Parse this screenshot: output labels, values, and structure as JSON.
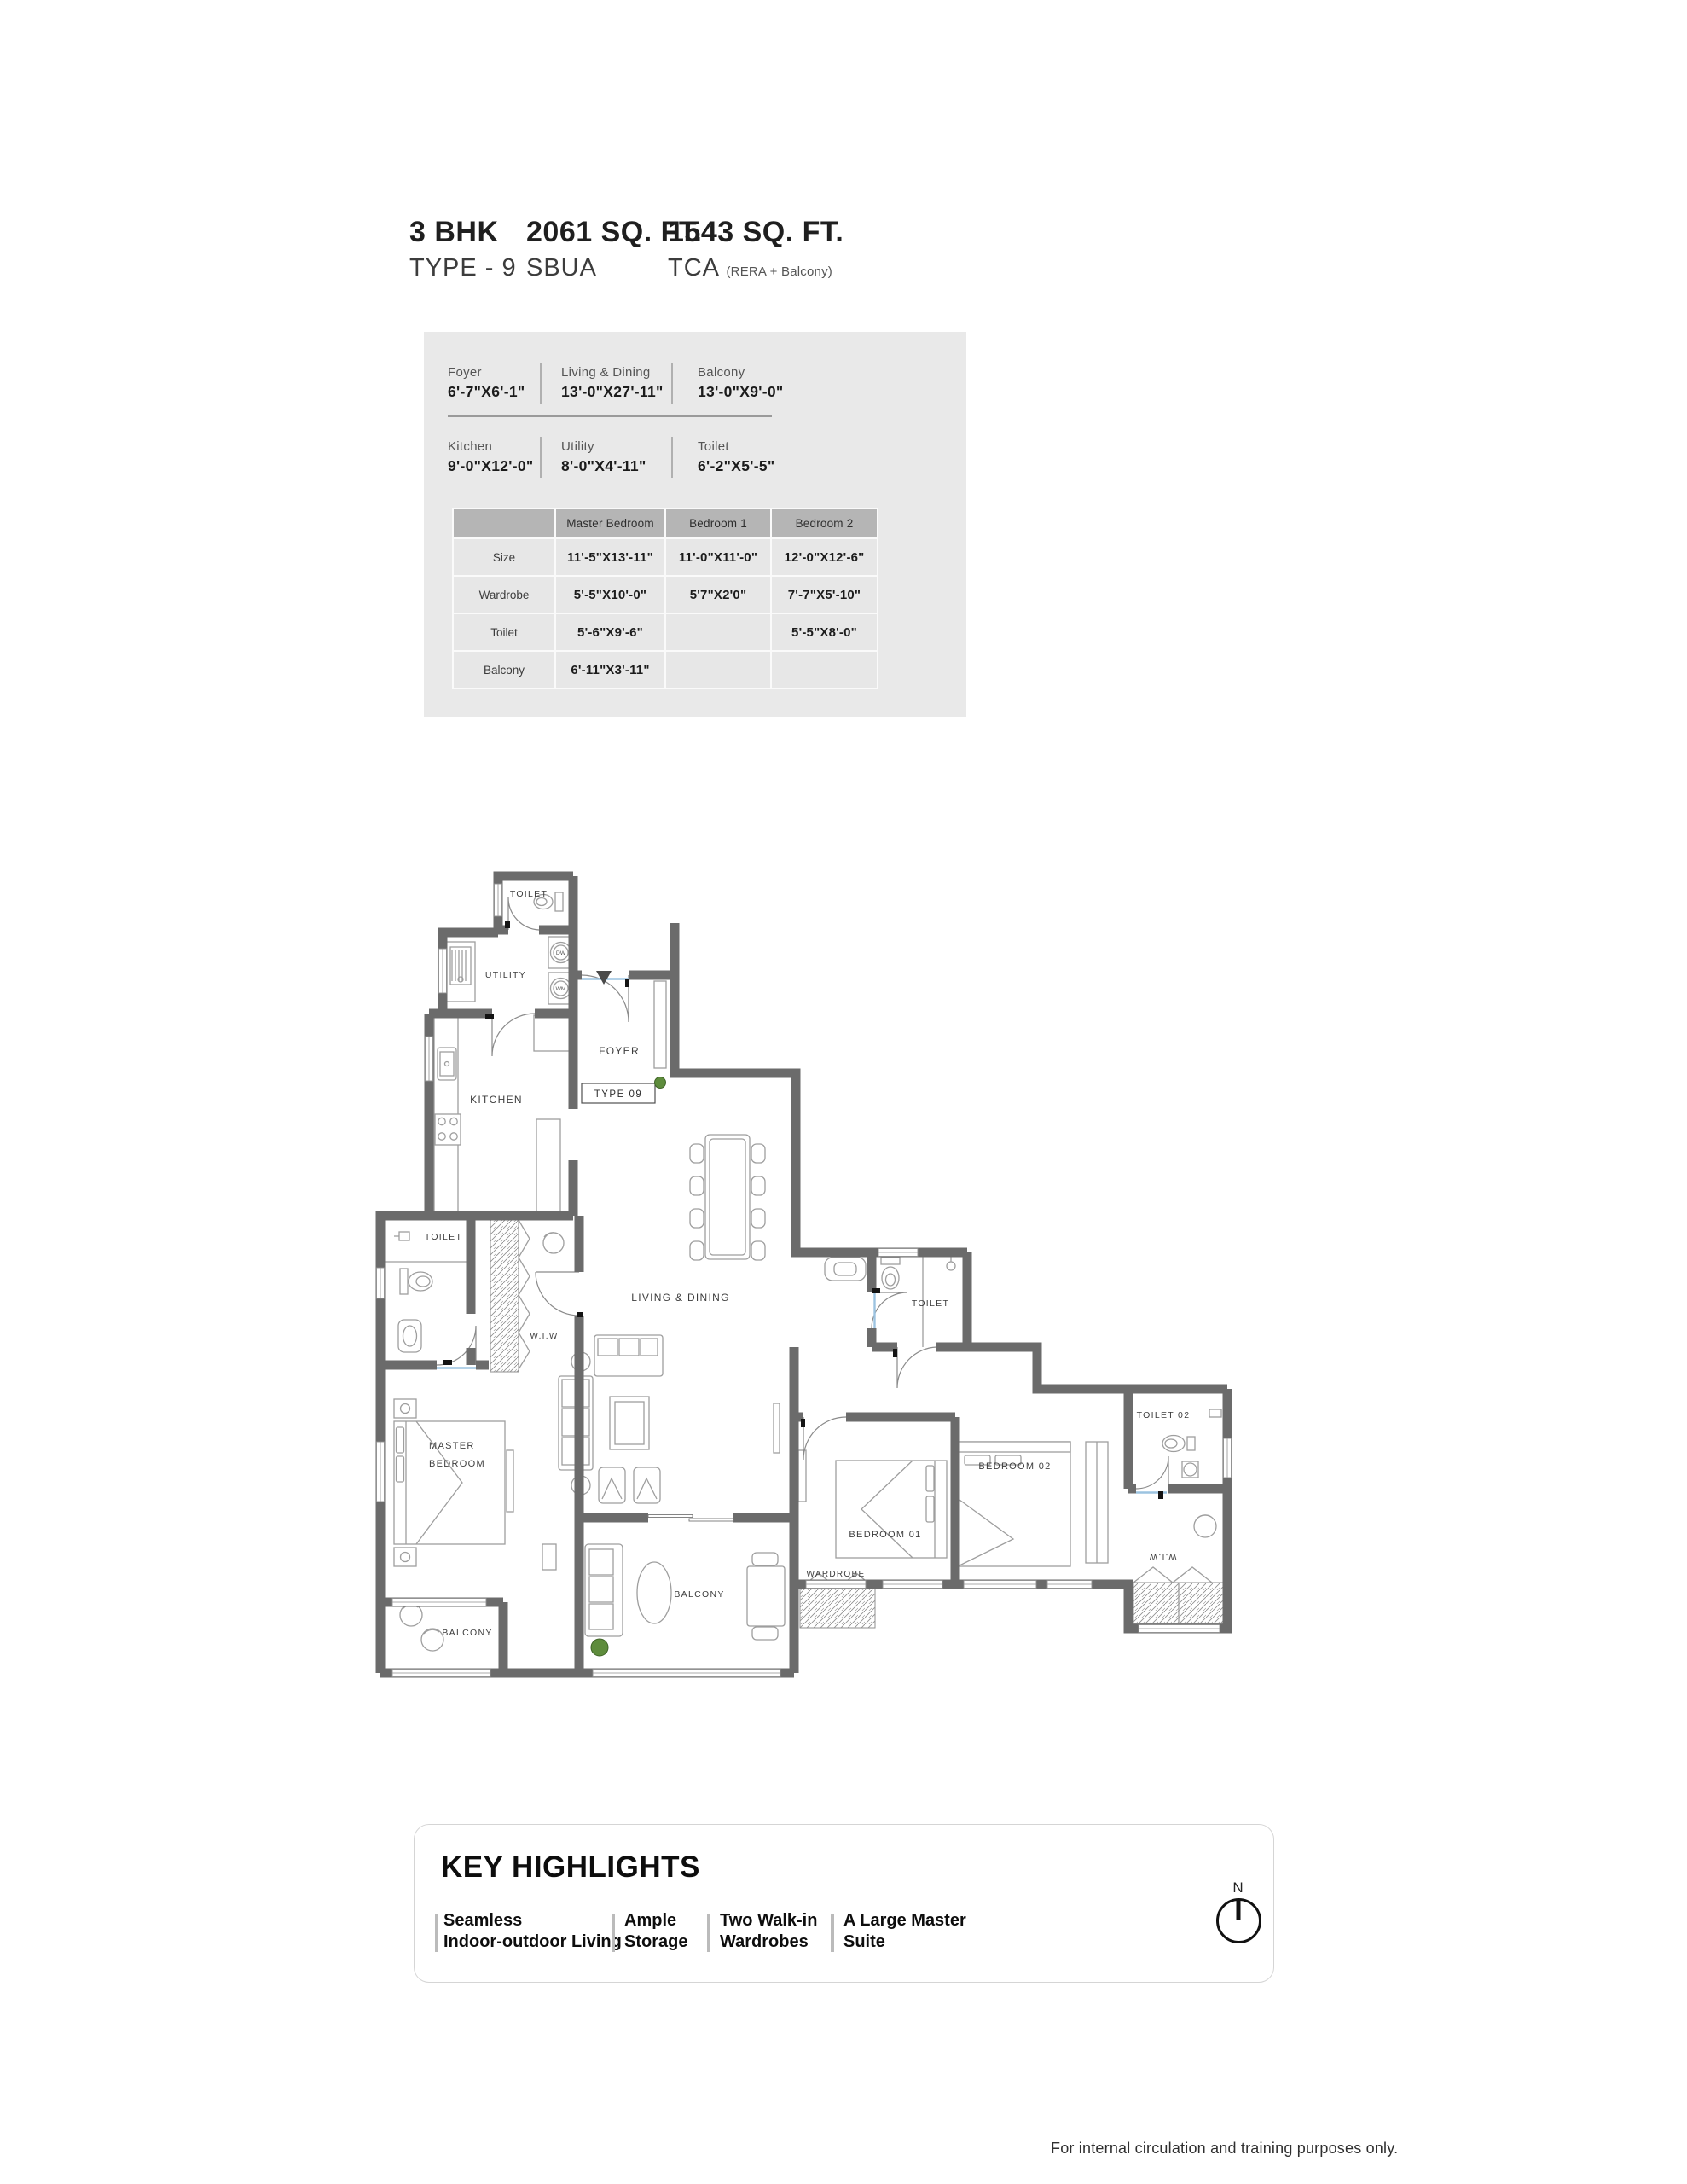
{
  "header": {
    "unit_type": "3 BHK",
    "unit_subtype": "TYPE - 9",
    "sbua_value": "2061 SQ. FT.",
    "sbua_label": "SBUA",
    "tca_value": "1543 SQ. FT.",
    "tca_label": "TCA",
    "tca_note": "(RERA + Balcony)"
  },
  "specs": {
    "row1": [
      {
        "label": "Foyer",
        "value": "6'-7\"X6'-1\""
      },
      {
        "label": "Living & Dining",
        "value": "13'-0\"X27'-11\""
      },
      {
        "label": "Balcony",
        "value": "13'-0\"X9'-0\""
      }
    ],
    "row2": [
      {
        "label": "Kitchen",
        "value": "9'-0\"X12'-0\""
      },
      {
        "label": "Utility",
        "value": "8'-0\"X4'-11\""
      },
      {
        "label": "Toilet",
        "value": "6'-2\"X5'-5\""
      }
    ]
  },
  "dimension_table": {
    "columns": [
      "",
      "Master Bedroom",
      "Bedroom 1",
      "Bedroom 2"
    ],
    "rows": [
      {
        "label": "Size",
        "values": [
          "11'-5\"X13'-11\"",
          "11'-0\"X11'-0\"",
          "12'-0\"X12'-6\""
        ]
      },
      {
        "label": "Wardrobe",
        "values": [
          "5'-5\"X10'-0\"",
          "5'7\"X2'0\"",
          "7'-7\"X5'-10\""
        ]
      },
      {
        "label": "Toilet",
        "values": [
          "5'-6\"X9'-6\"",
          "",
          "5'-5\"X8'-0\""
        ]
      },
      {
        "label": "Balcony",
        "values": [
          "6'-11\"X3'-11\"",
          "",
          ""
        ]
      }
    ]
  },
  "floor_plan": {
    "type_label": "TYPE 09",
    "rooms": {
      "toilet_top": "TOILET",
      "utility": "UTILITY",
      "foyer": "FOYER",
      "kitchen": "KITCHEN",
      "living_dining": "LIVING & DINING",
      "master_toilet": "TOILET",
      "master_wiw": "W.I.W",
      "master_bedroom_line1": "MASTER",
      "master_bedroom_line2": "BEDROOM",
      "balcony_left": "BALCONY",
      "balcony_center": "BALCONY",
      "bedroom1_toilet": "TOILET",
      "bedroom1": "BEDROOM 01",
      "bedroom1_wardrobe": "WARDROBE",
      "bedroom2": "BEDROOM 02",
      "toilet2": "TOILET 02",
      "wiw_right": "W.I.W"
    },
    "appliances": {
      "dishwasher": "DW",
      "washing_machine": "WM"
    }
  },
  "highlights": {
    "title": "KEY HIGHLIGHTS",
    "items": [
      {
        "line1": "Seamless",
        "line2": "Indoor-outdoor Living"
      },
      {
        "line1": "Ample",
        "line2": "Storage"
      },
      {
        "line1": "Two Walk-in",
        "line2": "Wardrobes"
      },
      {
        "line1": "A Large Master",
        "line2": "Suite"
      }
    ],
    "compass_label": "N"
  },
  "footer": {
    "note": "For internal circulation and training purposes only."
  }
}
